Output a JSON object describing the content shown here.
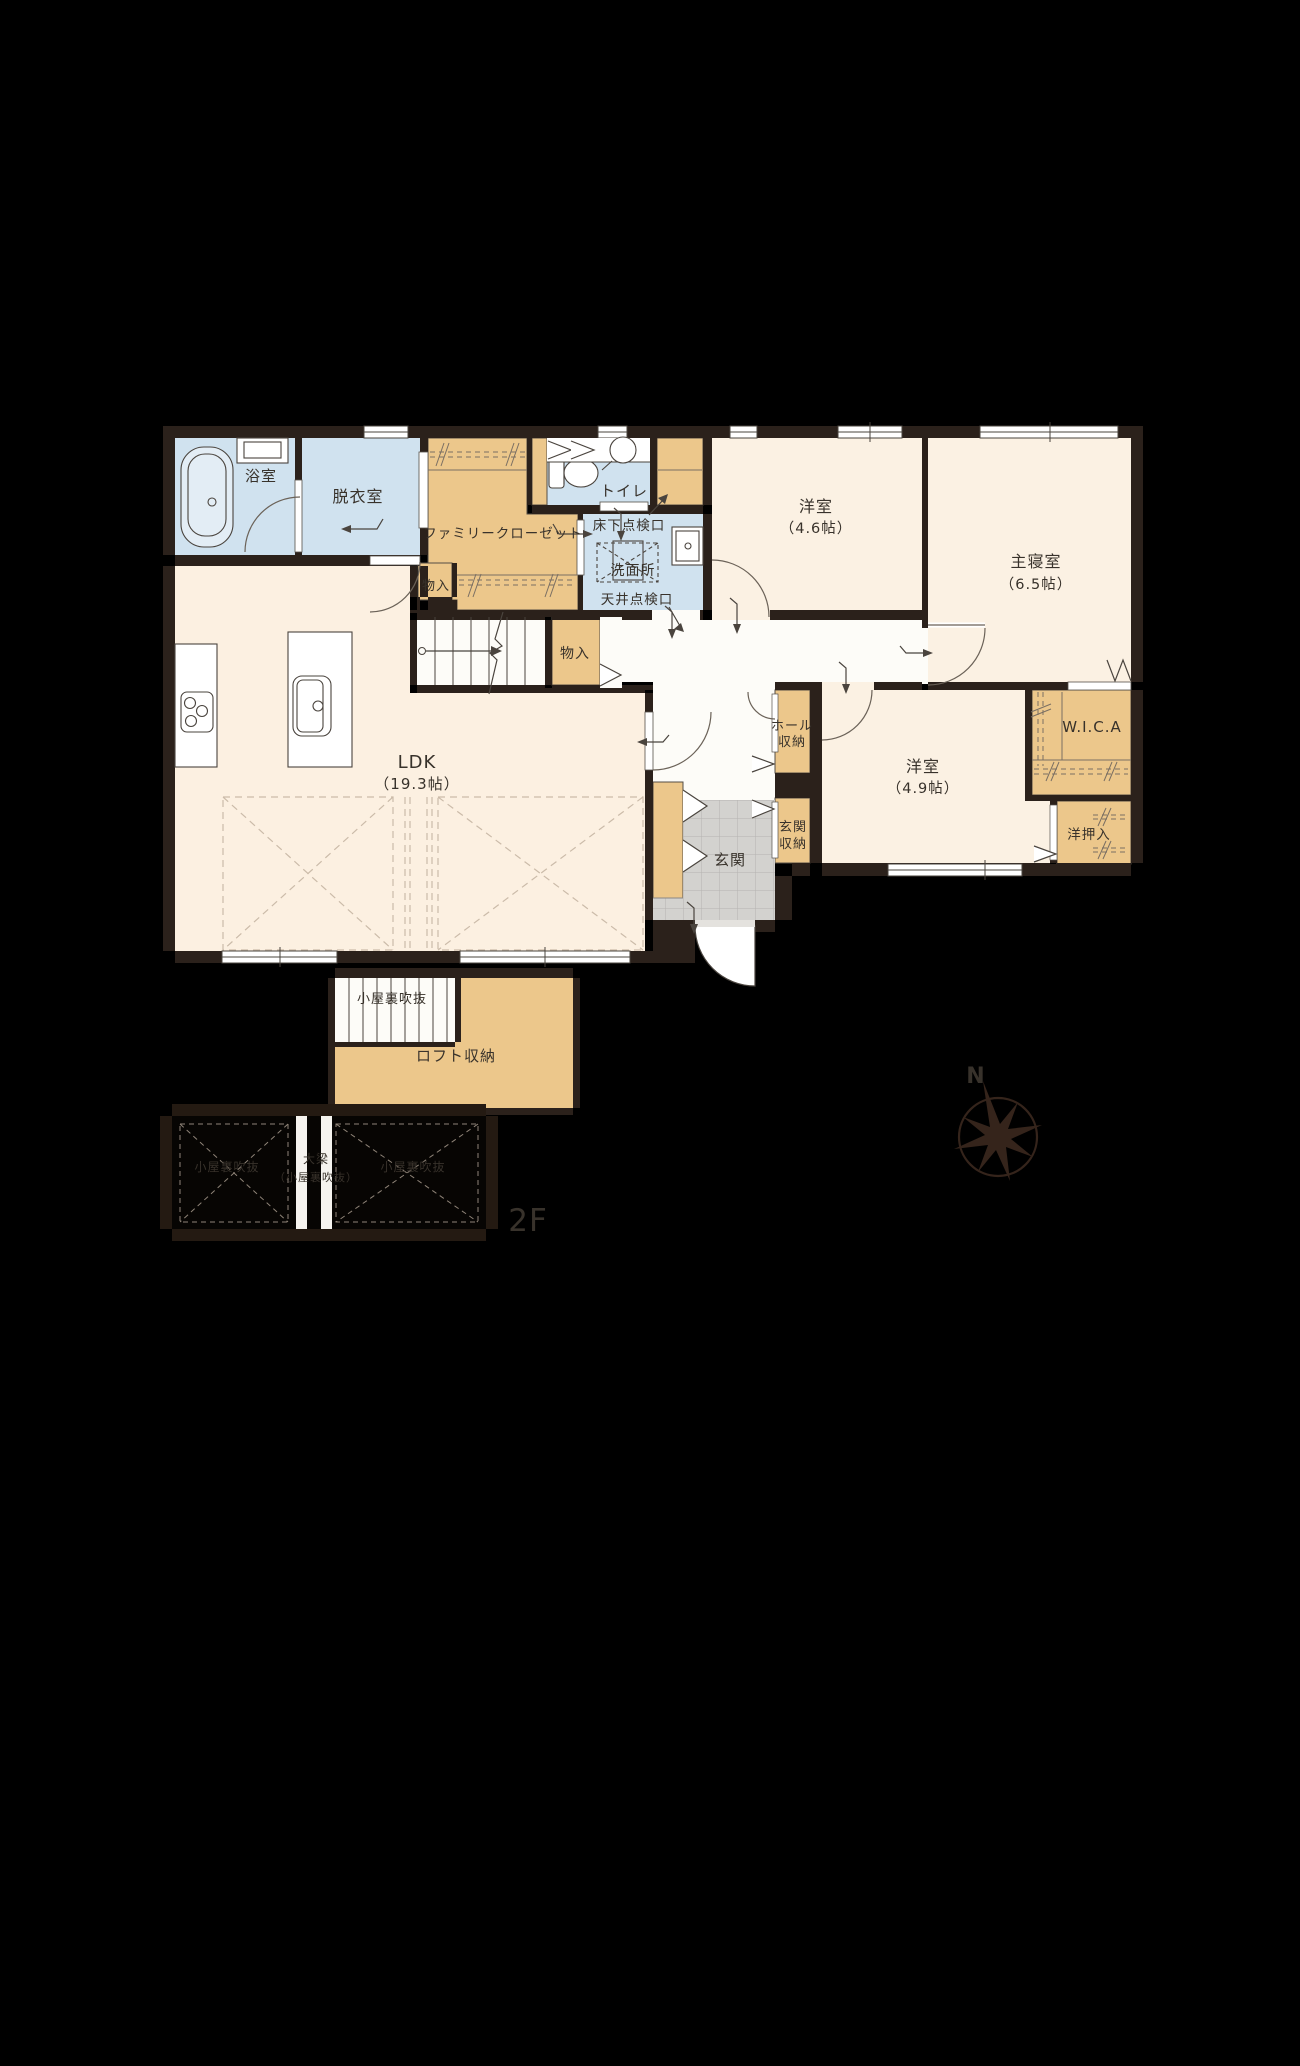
{
  "palette": {
    "background": "#000000",
    "wall": "#2b211b",
    "floor_cream": "#fbf1e3",
    "floor_ldk": "#fcf0e1",
    "floor_hall": "#fdfcf8",
    "floor_wet_blue": "#d0e2ef",
    "closet_tan": "#ecc78b",
    "genkan_gray": "#d3d2cf",
    "line_dark": "#4a443e",
    "dash_light": "#cbbba9",
    "compass_brown": "#35241b",
    "attic_text_gray": "#8f8880",
    "floor_tag_gray": "#7d7d7d"
  },
  "floor1": {
    "bath": {
      "label": "浴室"
    },
    "dressing_room": {
      "label": "脱衣室"
    },
    "family_closet": {
      "label": "ファミリークローゼット"
    },
    "storage_closet_a": {
      "label": "物入"
    },
    "storage_closet_b": {
      "label": "物入"
    },
    "toilet": {
      "label": "トイレ"
    },
    "underfloor_hatch": {
      "label": "床下点検口"
    },
    "washroom": {
      "label": "洗面所"
    },
    "ceiling_hatch": {
      "label": "天井点検口"
    },
    "bedroom_a": {
      "label": "洋室",
      "size": "（4.6帖）"
    },
    "master_bedroom": {
      "label": "主寝室",
      "size": "（6.5帖）"
    },
    "ldk": {
      "label": "LDK",
      "size": "（19.3帖）"
    },
    "hall_storage": {
      "line1": "ホール",
      "line2": "収納"
    },
    "wic": {
      "label": "W.I.C.A"
    },
    "bedroom_b": {
      "label": "洋室",
      "size": "（4.9帖）"
    },
    "genkan": {
      "label": "玄関"
    },
    "genkan_storage": {
      "line1": "玄関",
      "line2": "収納"
    },
    "oshiire": {
      "label": "洋押入"
    }
  },
  "floor2": {
    "stairwell_void": {
      "label": "小屋裏吹抜"
    },
    "loft_storage": {
      "label": "ロフト収納"
    },
    "attic_void_left": {
      "label": "小屋裏吹抜"
    },
    "beam": {
      "line1": "大梁",
      "line2": "（小屋裏吹抜）"
    },
    "attic_void_right": {
      "label": "小屋裏吹抜"
    },
    "floor_tag": "2F"
  },
  "compass": {
    "north_label": "N"
  }
}
